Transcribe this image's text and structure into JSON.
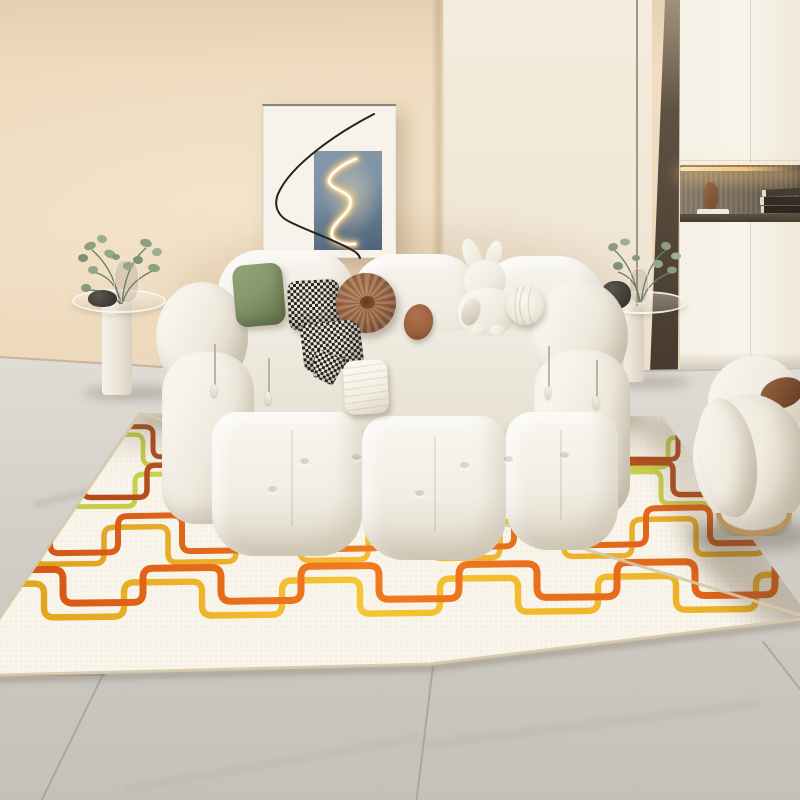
{
  "scene": {
    "description": "bright living room: white boucle modular sofa, abstract framed art, cream rug with retro square-wave lines, grey marble tile floor",
    "window_size": "800x800"
  },
  "palette": {
    "wall": "#eed9bc",
    "wall_panel": "#f2e9d8",
    "floor_mid": "#d4d0ca",
    "cabinet_door": "#f6f1e6",
    "sofa_fabric": "#f1ede3",
    "pillow_green": "#87976b",
    "pillow_brown": "#9a6847",
    "pillow_oval": "#9c6240",
    "pillow_lumbar": "#f2eee2",
    "check_dark": "#26231f",
    "check_light": "#efeae0",
    "ring_gold": "#bb9159",
    "glass_rim": "rgba(250,247,240,0.9)",
    "tile_seam": "rgba(150,143,133,0.55)",
    "base_line": "rgba(145,125,98,0.4)"
  },
  "artwork": {
    "frame": "#f7f3ea",
    "canvas_top": "#8598aa",
    "canvas_bottom": "#4f637a",
    "squiggle_core": "#fffdf6",
    "squiggle_mid": "#ffe2ae",
    "squiggle_glow": "#f7c678",
    "line": "#26221c"
  },
  "cabinet": {
    "frame": "#54473a",
    "niche_back": "#7c7060",
    "led": "#ffe3ae",
    "shelf": "#4a4136",
    "sculpture": "#8a5f3e",
    "books": [
      "#453c31",
      "#332d26",
      "#2c2721"
    ]
  },
  "plants": {
    "stem": "#6f7f63",
    "leaf_a": "#8ca081",
    "leaf_b": "#9bb090",
    "leaf_c": "#7e9173"
  },
  "rug": {
    "base": "#f8f4e9",
    "binding": "#d5c8ab",
    "speckle": "rgba(120,105,80,0.06)",
    "clip": "140,413 662,416 810,618 430,664 -40,676",
    "rows": [
      {
        "name": "row-1",
        "y": 426,
        "amp": 30,
        "period": 115,
        "top_w": 50,
        "phase": 103,
        "slope": 0.005,
        "stroke": 5,
        "radius": 8,
        "offset": [
          -10,
          8
        ],
        "primary": [
          "#9e4015",
          "#bb5520",
          "#a64618"
        ],
        "secondary": [
          "#b8c23c",
          "#d0d655",
          "#bfc743"
        ]
      },
      {
        "name": "row-2",
        "y": 466,
        "amp": 32,
        "period": 118,
        "top_w": 54,
        "phase": 29,
        "slope": -0.005,
        "stroke": 5.5,
        "radius": 8,
        "offset": [
          -12,
          9
        ],
        "primary": [
          "#a94617",
          "#c25722",
          "#ab4a1a"
        ],
        "secondary": [
          "#bdc73f",
          "#d4da58",
          "#c2ca45"
        ]
      },
      {
        "name": "row-3",
        "y": 518,
        "amp": 36,
        "period": 132,
        "top_w": 64,
        "phase": 118,
        "slope": -0.015,
        "stroke": 6,
        "radius": 9,
        "offset": [
          -14,
          11
        ],
        "primary": [
          "#cc4c13",
          "#ee7a22",
          "#d85818"
        ],
        "secondary": [
          "#d89a1b",
          "#f4bd33",
          "#e2a523"
        ]
      },
      {
        "name": "row-4",
        "y": 570,
        "amp": 34,
        "period": 158,
        "top_w": 78,
        "phase": -15,
        "slope": -0.012,
        "stroke": 7,
        "radius": 10,
        "offset": [
          -19,
          14
        ],
        "primary": [
          "#d34d12",
          "#f07c1f",
          "#dd5c16"
        ],
        "secondary": [
          "#de9e1a",
          "#f7c433",
          "#e8ab22"
        ]
      }
    ]
  }
}
